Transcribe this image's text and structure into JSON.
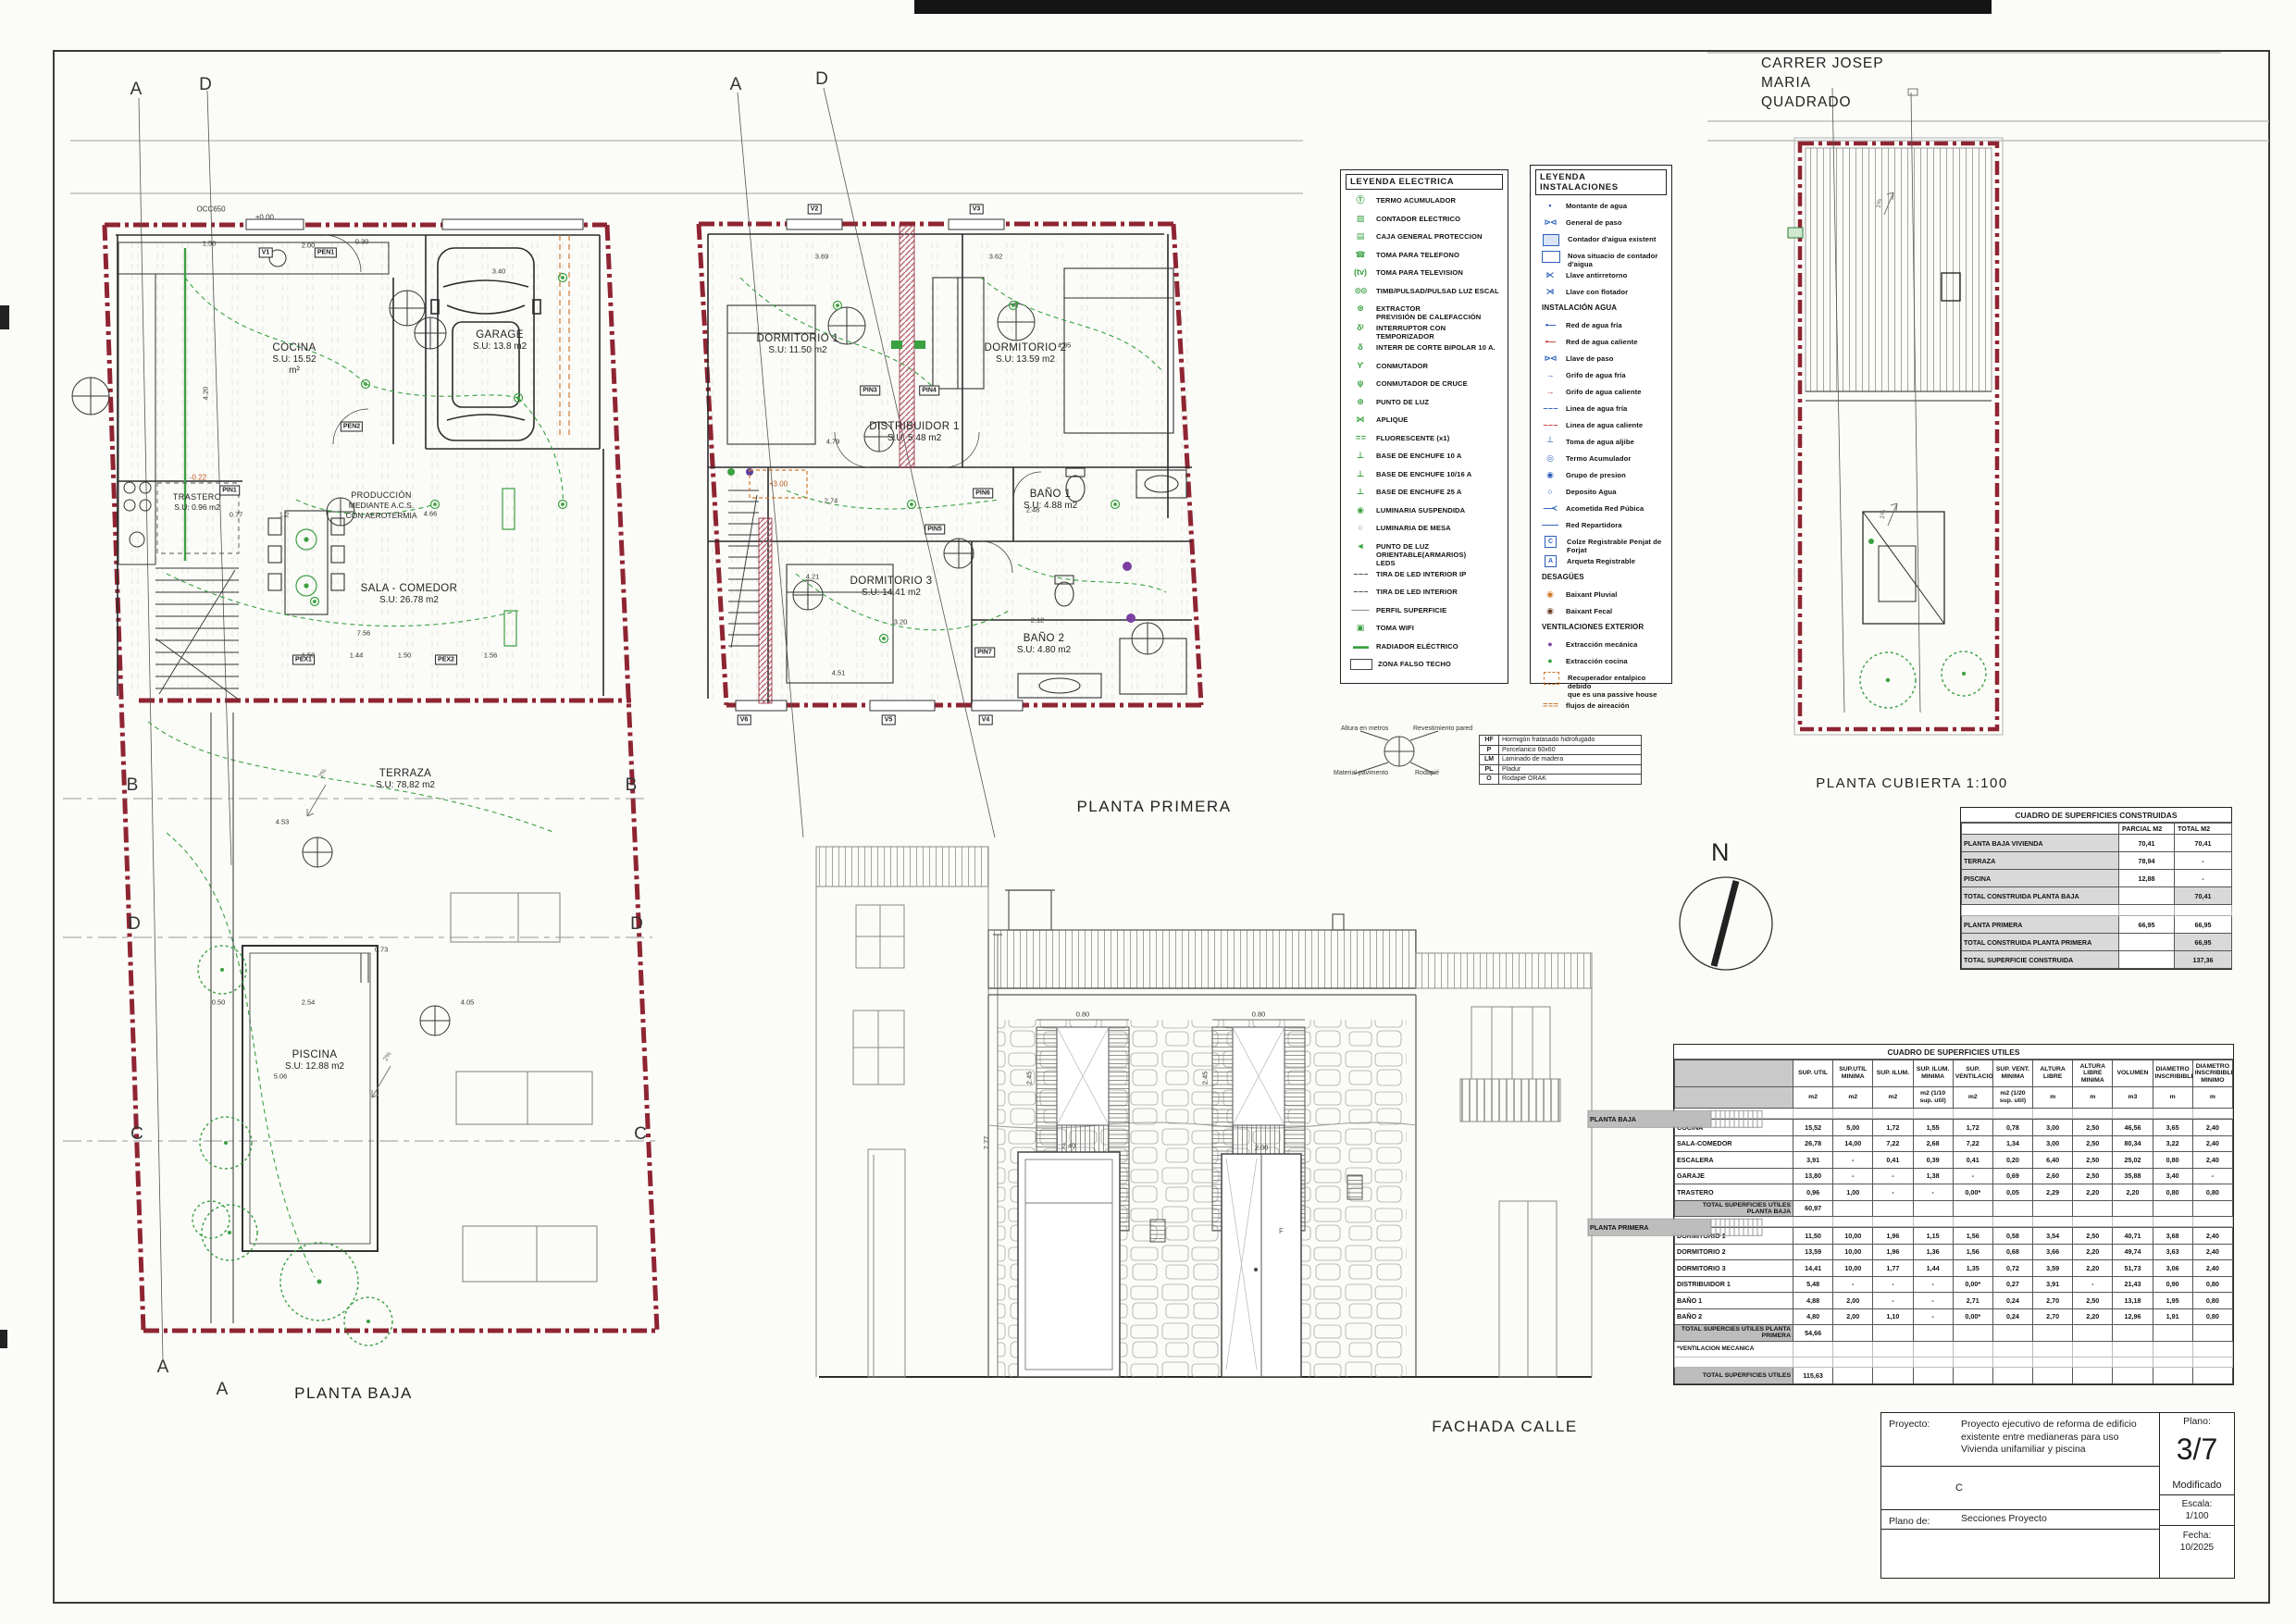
{
  "titles": {
    "planta_baja": "PLANTA BAJA",
    "planta_primera": "PLANTA PRIMERA",
    "planta_cubierta": "PLANTA CUBIERTA 1:100",
    "fachada": "FACHADA CALLE",
    "street": [
      "CARRER JOSEP",
      "MARIA",
      "QUADRADO"
    ],
    "north": "N"
  },
  "plans": {
    "baja": {
      "rooms": [
        {
          "name": "COCINA",
          "area": "S.U: 15.52",
          "area2": "m²"
        },
        {
          "name": "GARAGE",
          "area": "S.U: 13.8 m2"
        },
        {
          "name": "TRASTERO",
          "area": "S.U: 0.96 m2"
        },
        {
          "name": "PRODUCCIÓN",
          "area": "MEDIANTE A.C.S.",
          "area2": "CON AEROTERMIA"
        },
        {
          "name": "SALA - COMEDOR",
          "area": "S.U: 26.78 m2"
        },
        {
          "name": "TERRAZA",
          "area": "S.U: 78,82 m2"
        },
        {
          "name": "PISCINA",
          "area": "S.U: 12.88 m2"
        }
      ],
      "tags": [
        "V1",
        "PEN1",
        "PEN2",
        "PIN1",
        "PEX1",
        "PEX2"
      ],
      "levels": [
        "OCC650",
        "±0.00",
        "-0.22"
      ],
      "sections": [
        "A",
        "D",
        "B",
        "B",
        "D",
        "D",
        "C",
        "C",
        "A",
        "A"
      ],
      "slopes": [
        "2%",
        "2%"
      ],
      "dims": [
        "1.50",
        "2.00",
        "0.30",
        "3.40",
        "4.20",
        "0.77",
        "1.2",
        "4.66",
        "7.56",
        "1.50",
        "1.44",
        "1.50",
        "1.56",
        "4.53",
        "0.73",
        "2.54",
        "0.50",
        "4.05",
        "5.06"
      ]
    },
    "primera": {
      "rooms": [
        {
          "name": "DORMITORIO 1",
          "area": "S.U: 11.50 m2"
        },
        {
          "name": "DORMITORIO 2",
          "area": "S.U: 13.59 m2"
        },
        {
          "name": "DISTRIBUIDOR 1",
          "area": "S.U: 5.48 m2"
        },
        {
          "name": "BAÑO 1",
          "area": "S.U: 4.88 m2"
        },
        {
          "name": "DORMITORIO 3",
          "area": "S.U: 14.41 m2"
        },
        {
          "name": "BAÑO 2",
          "area": "S.U: 4.80 m2"
        }
      ],
      "tags": [
        "V2",
        "V3",
        "PIN3",
        "PIN4",
        "PIN5",
        "PIN6",
        "PIN7",
        "V6",
        "V5",
        "V4"
      ],
      "levels": [
        "+3.00"
      ],
      "sections": [
        "A",
        "D"
      ],
      "dims": [
        "3.69",
        "3.62",
        "4.05",
        "2.48",
        "4.79",
        "2.74",
        "4.21",
        "4.51",
        "2.12",
        "3.20"
      ]
    },
    "cubierta": {
      "slopes": [
        "1%",
        "1%"
      ]
    },
    "fachada": {
      "dims": [
        "0.80",
        "0.80",
        "2.45",
        "2.45",
        "2.40",
        "2.00",
        "7.77"
      ],
      "letter_f": "F"
    }
  },
  "legend_electrica": {
    "title": "LEYENDA ELECTRICA",
    "items": [
      {
        "cls": "ic g",
        "glyph": "Ⓣ",
        "label": "TERMO ACUMULADOR"
      },
      {
        "cls": "ic g",
        "glyph": "▨",
        "label": "CONTADOR ELECTRICO"
      },
      {
        "cls": "ic g",
        "glyph": "▤",
        "label": "CAJA GENERAL PROTECCION"
      },
      {
        "cls": "ic g",
        "glyph": "☎",
        "label": "TOMA PARA TELEFONO"
      },
      {
        "cls": "ic g",
        "glyph": "(tv)",
        "label": "TOMA PARA TELEVISION"
      },
      {
        "cls": "ic g wide",
        "glyph": "⊙⊙",
        "label": "TIMB/PULSAD/PULSAD LUZ ESCAL"
      },
      {
        "cls": "ic g",
        "glyph": "⊛",
        "label": "EXTRACTOR",
        "label2": "PREVISIÓN DE CALEFACCIÓN"
      },
      {
        "cls": "ic g",
        "glyph": "δᵗ",
        "label": "INTERRUPTOR CON TEMPORIZADOR"
      },
      {
        "cls": "ic g",
        "glyph": "δ",
        "label": "INTERR DE CORTE BIPOLAR 10 A."
      },
      {
        "cls": "ic g",
        "glyph": "ϒ",
        "label": "CONMUTADOR"
      },
      {
        "cls": "ic g",
        "glyph": "ψ",
        "label": "CONMUTADOR DE CRUCE"
      },
      {
        "cls": "ic g",
        "glyph": "⊕",
        "label": "PUNTO DE LUZ"
      },
      {
        "cls": "ic g",
        "glyph": "⋈",
        "label": "APLIQUE"
      },
      {
        "cls": "ic g wide",
        "glyph": "= =",
        "label": "FLUORESCENTE (x1)"
      },
      {
        "cls": "ic g",
        "glyph": "⊥",
        "label": "BASE DE ENCHUFE 10 A"
      },
      {
        "cls": "ic g",
        "glyph": "⊥",
        "label": "BASE DE ENCHUFE 10/16 A"
      },
      {
        "cls": "ic g",
        "glyph": "⊥",
        "label": "BASE DE ENCHUFE 25 A"
      },
      {
        "cls": "ic g",
        "glyph": "◉",
        "label": "LUMINARIA SUSPENDIDA"
      },
      {
        "cls": "ic g",
        "glyph": "○",
        "label": "LUMINARIA DE MESA"
      },
      {
        "cls": "ic g",
        "glyph": "◄",
        "label": "PUNTO DE LUZ ORIENTABLE(ARMARIOS)",
        "label2": "LEDS"
      },
      {
        "cls": "ic k wide",
        "glyph": "– – –",
        "label": "TIRA DE LED INTERIOR IP"
      },
      {
        "cls": "ic k wide",
        "glyph": "– – –",
        "label": "TIRA DE LED INTERIOR"
      },
      {
        "cls": "ic k",
        "glyph": "───",
        "label": "PERFIL SUPERFICIE"
      },
      {
        "cls": "ic g",
        "glyph": "▣",
        "label": "TOMA WIFI"
      },
      {
        "cls": "ic g wide",
        "glyph": "▬▬",
        "label": "RADIADOR ELÉCTRICO"
      },
      {
        "cls": "ic swatch",
        "glyph": "",
        "label": "ZONA FALSO TECHO"
      }
    ]
  },
  "legend_instalaciones": {
    "title": "LEYENDA INSTALACIONES",
    "items": [
      {
        "cls": "ic b",
        "glyph": "•",
        "label": "Montante de agua"
      },
      {
        "cls": "ic b wide",
        "glyph": "⊳⊲",
        "label": "General de paso"
      },
      {
        "cls": "ic bbox",
        "glyph": "",
        "label": "Contador d'aigua existent"
      },
      {
        "cls": "ic bbox2",
        "glyph": "",
        "label": "Nova situacio de contador d'aigua"
      },
      {
        "cls": "ic b",
        "glyph": "⋉",
        "label": "Llave antirretorno"
      },
      {
        "cls": "ic b",
        "glyph": "⋊",
        "label": "Llave con flotador"
      },
      {
        "licls": "lh",
        "cls": "ic none",
        "glyph": "",
        "label": "INSTALACIÓN AGUA"
      },
      {
        "cls": "ic b wide",
        "glyph": "•—",
        "label": "Red de agua fría"
      },
      {
        "cls": "ic r wide",
        "glyph": "•—",
        "label": "Red de agua caliente"
      },
      {
        "cls": "ic b wide",
        "glyph": "⊳⊲",
        "label": "Llave de paso"
      },
      {
        "cls": "ic b",
        "glyph": "→",
        "label": "Grifo de agua fría"
      },
      {
        "cls": "ic r",
        "glyph": "→",
        "label": "Grifo de agua caliente"
      },
      {
        "cls": "ic b wide",
        "glyph": "– – –",
        "label": "Linea de agua fría"
      },
      {
        "cls": "ic r wide",
        "glyph": "– – –",
        "label": "Linea de agua caliente"
      },
      {
        "cls": "ic b",
        "glyph": "┴",
        "label": "Toma de agua aljibe"
      },
      {
        "cls": "ic b",
        "glyph": "◎",
        "label": "Termo Acumulador"
      },
      {
        "cls": "ic b",
        "glyph": "◉",
        "label": "Grupo de presion"
      },
      {
        "cls": "ic b",
        "glyph": "○",
        "label": "Deposito Agua"
      },
      {
        "cls": "ic b wide",
        "glyph": "—≺",
        "label": "Acometida Red Púbica"
      },
      {
        "cls": "ic b",
        "glyph": "——",
        "label": "Red Repartidora"
      },
      {
        "cls": "ic bsq",
        "glyph": "C",
        "label": "Colze Registrable Penjat de Forjat"
      },
      {
        "cls": "ic bsq",
        "glyph": "A",
        "label": "Arqueta Registrable"
      },
      {
        "licls": "lh",
        "cls": "ic none",
        "glyph": "",
        "label": "DESAGÜES"
      },
      {
        "cls": "ic o",
        "glyph": "◉",
        "label": "Baixant Pluvial"
      },
      {
        "cls": "ic br",
        "glyph": "◉",
        "label": "Baixant Fecal"
      },
      {
        "licls": "lh",
        "cls": "ic none",
        "glyph": "",
        "label": "VENTILACIONES EXTERIOR"
      },
      {
        "cls": "ic pu",
        "glyph": "●",
        "label": "Extracción mecánica"
      },
      {
        "cls": "ic g",
        "glyph": "●",
        "label": "Extracción cocina"
      },
      {
        "cls": "ic obox",
        "glyph": "",
        "label": "Recuperador entalpico debido",
        "label2": "que es una passive house"
      },
      {
        "cls": "ic o wide",
        "glyph": "= = =",
        "label": "flujos de aireación"
      }
    ]
  },
  "material_key": {
    "labels": [
      "Altura en metros",
      "Revestimiento pared",
      "Material pavimento",
      "Rodapié"
    ],
    "rows": [
      {
        "k": "HF",
        "v": "Hormigón fratasado hidrofugado"
      },
      {
        "k": "P",
        "v": "Porcelanico 60x60"
      },
      {
        "k": "LM",
        "v": "Laminado de madera"
      },
      {
        "k": "PL",
        "v": "Pladur"
      },
      {
        "k": "O",
        "v": "Rodapié ORAK"
      }
    ]
  },
  "tables": {
    "construidas": {
      "title": "CUADRO DE SUPERFICIES CONSTRUIDAS",
      "col1": "PARCIAL M2",
      "col2": "TOTAL M2",
      "rows": [
        {
          "cls": "",
          "label": "PLANTA BAJA VIVIENDA",
          "parcial": "70,41",
          "total": "70,41"
        },
        {
          "cls": "",
          "label": "TERRAZA",
          "parcial": "78,94",
          "total": "-"
        },
        {
          "cls": "",
          "label": "PISCINA",
          "parcial": "12,88",
          "total": "-"
        },
        {
          "cls": "tot",
          "label": "TOTAL CONSTRUIDA PLANTA BAJA",
          "parcial": "",
          "total": "70,41"
        },
        {
          "cls": "spacer",
          "label": "",
          "parcial": "",
          "total": ""
        },
        {
          "cls": "",
          "label": "PLANTA PRIMERA",
          "parcial": "66,95",
          "total": "66,95"
        },
        {
          "cls": "tot",
          "label": "TOTAL CONSTRUIDA PLANTA PRIMERA",
          "parcial": "",
          "total": "66,95"
        },
        {
          "cls": "tot",
          "label": "TOTAL SUPERFICIE CONSTRUIDA",
          "parcial": "",
          "total": "137,36"
        }
      ]
    },
    "utiles": {
      "title": "CUADRO DE SUPERFICIES UTILES",
      "headers": [
        {
          "name": "SUP. UTIL",
          "unit": "m2"
        },
        {
          "name": "SUP.UTIL MINIMA",
          "unit": "m2"
        },
        {
          "name": "SUP. ILUM.",
          "unit": "m2"
        },
        {
          "name": "SUP. ILUM. MINIMA",
          "unit": "m2 (1/10 sup. util)"
        },
        {
          "name": "SUP. VENTILACION",
          "unit": "m2"
        },
        {
          "name": "SUP. VENT. MINIMA",
          "unit": "m2 (1/20 sup. util)"
        },
        {
          "name": "ALTURA LIBRE",
          "unit": "m"
        },
        {
          "name": "ALTURA LIBRE MINIMA",
          "unit": "m"
        },
        {
          "name": "VOLUMEN",
          "unit": "m3"
        },
        {
          "name": "DIAMETRO INSCRIBIBLE",
          "unit": "m"
        },
        {
          "name": "DIAMETRO INSCRIBIBLE MINIMO",
          "unit": "m"
        }
      ],
      "rows": [
        {
          "cls": "gap"
        },
        {
          "cls": "sec",
          "c0": "PLANTA BAJA"
        },
        {
          "cls": "",
          "c0": "COCINA",
          "c1": "15,52",
          "c2": "5,00",
          "c3": "1,72",
          "c4": "1,55",
          "c5": "1,72",
          "c6": "0,78",
          "c7": "3,00",
          "c8": "2,50",
          "c9": "46,56",
          "c10": "3,65",
          "c11": "2,40"
        },
        {
          "cls": "",
          "c0": "SALA-COMEDOR",
          "c1": "26,78",
          "c2": "14,00",
          "c3": "7,22",
          "c4": "2,68",
          "c5": "7,22",
          "c6": "1,34",
          "c7": "3,00",
          "c8": "2,50",
          "c9": "80,34",
          "c10": "3,22",
          "c11": "2,40"
        },
        {
          "cls": "",
          "c0": "ESCALERA",
          "c1": "3,91",
          "c2": "-",
          "c3": "0,41",
          "c4": "0,39",
          "c5": "0,41",
          "c6": "0,20",
          "c7": "6,40",
          "c8": "2,50",
          "c9": "25,02",
          "c10": "0,80",
          "c11": "2,40"
        },
        {
          "cls": "",
          "c0": "GARAJE",
          "c1": "13,80",
          "c2": "-",
          "c3": "-",
          "c4": "1,38",
          "c5": "-",
          "c6": "0,69",
          "c7": "2,60",
          "c8": "2,50",
          "c9": "35,88",
          "c10": "3,40",
          "c11": "-"
        },
        {
          "cls": "",
          "c0": "TRASTERO",
          "c1": "0,96",
          "c2": "1,00",
          "c3": "-",
          "c4": "-",
          "c5": "0,00*",
          "c6": "0,05",
          "c7": "2,29",
          "c8": "2,20",
          "c9": "2,20",
          "c10": "0,80",
          "c11": "0,80"
        },
        {
          "cls": "tot",
          "c0": "TOTAL SUPERFICIES UTILES PLANTA BAJA",
          "c1": "60,97"
        },
        {
          "cls": "gap"
        },
        {
          "cls": "sec",
          "c0": "PLANTA PRIMERA"
        },
        {
          "cls": "",
          "c0": "DORMITORIO 1",
          "c1": "11,50",
          "c2": "10,00",
          "c3": "1,96",
          "c4": "1,15",
          "c5": "1,56",
          "c6": "0,58",
          "c7": "3,54",
          "c8": "2,50",
          "c9": "40,71",
          "c10": "3,68",
          "c11": "2,40"
        },
        {
          "cls": "",
          "c0": "DORMITORIO 2",
          "c1": "13,59",
          "c2": "10,00",
          "c3": "1,96",
          "c4": "1,36",
          "c5": "1,56",
          "c6": "0,68",
          "c7": "3,66",
          "c8": "2,20",
          "c9": "49,74",
          "c10": "3,63",
          "c11": "2,40"
        },
        {
          "cls": "",
          "c0": "DORMITORIO 3",
          "c1": "14,41",
          "c2": "10,00",
          "c3": "1,77",
          "c4": "1,44",
          "c5": "1,35",
          "c6": "0,72",
          "c7": "3,59",
          "c8": "2,20",
          "c9": "51,73",
          "c10": "3,06",
          "c11": "2,40"
        },
        {
          "cls": "",
          "c0": "DISTRIBUIDOR 1",
          "c1": "5,48",
          "c2": "-",
          "c3": "-",
          "c4": "-",
          "c5": "0,00*",
          "c6": "0,27",
          "c7": "3,91",
          "c8": "-",
          "c9": "21,43",
          "c10": "0,90",
          "c11": "0,80"
        },
        {
          "cls": "",
          "c0": "BAÑO 1",
          "c1": "4,88",
          "c2": "2,00",
          "c3": "-",
          "c4": "-",
          "c5": "2,71",
          "c6": "0,24",
          "c7": "2,70",
          "c8": "2,50",
          "c9": "13,18",
          "c10": "1,95",
          "c11": "0,80"
        },
        {
          "cls": "",
          "c0": "BAÑO 2",
          "c1": "4,80",
          "c2": "2,00",
          "c3": "1,10",
          "c4": "-",
          "c5": "0,00*",
          "c6": "0,24",
          "c7": "2,70",
          "c8": "2,20",
          "c9": "12,96",
          "c10": "1,91",
          "c11": "0,80"
        },
        {
          "cls": "tot",
          "c0": "TOTAL SUPERCIES UTILES PLANTA PRIMERA",
          "c1": "54,66"
        },
        {
          "cls": "note",
          "c0": "*VENTILACION MECANICA"
        },
        {
          "cls": "gap"
        },
        {
          "cls": "tot",
          "c0": "TOTAL SUPERFICIES UTILES",
          "c1": "115,63"
        }
      ]
    }
  },
  "title_block": {
    "proyecto_label": "Proyecto:",
    "proyecto": "Proyecto ejecutivo de reforma de edificio existente entre medianeras para uso Vivienda unifamiliar y piscina",
    "mid": "C",
    "plano_de_label": "Plano de:",
    "plano_de": "Secciones  Proyecto",
    "plano_label": "Plano:",
    "plano_num": "3/7",
    "modificado": "Modificado",
    "escala_label": "Escala:",
    "escala": "1/100",
    "fecha_label": "Fecha:",
    "fecha": "10/2025"
  }
}
